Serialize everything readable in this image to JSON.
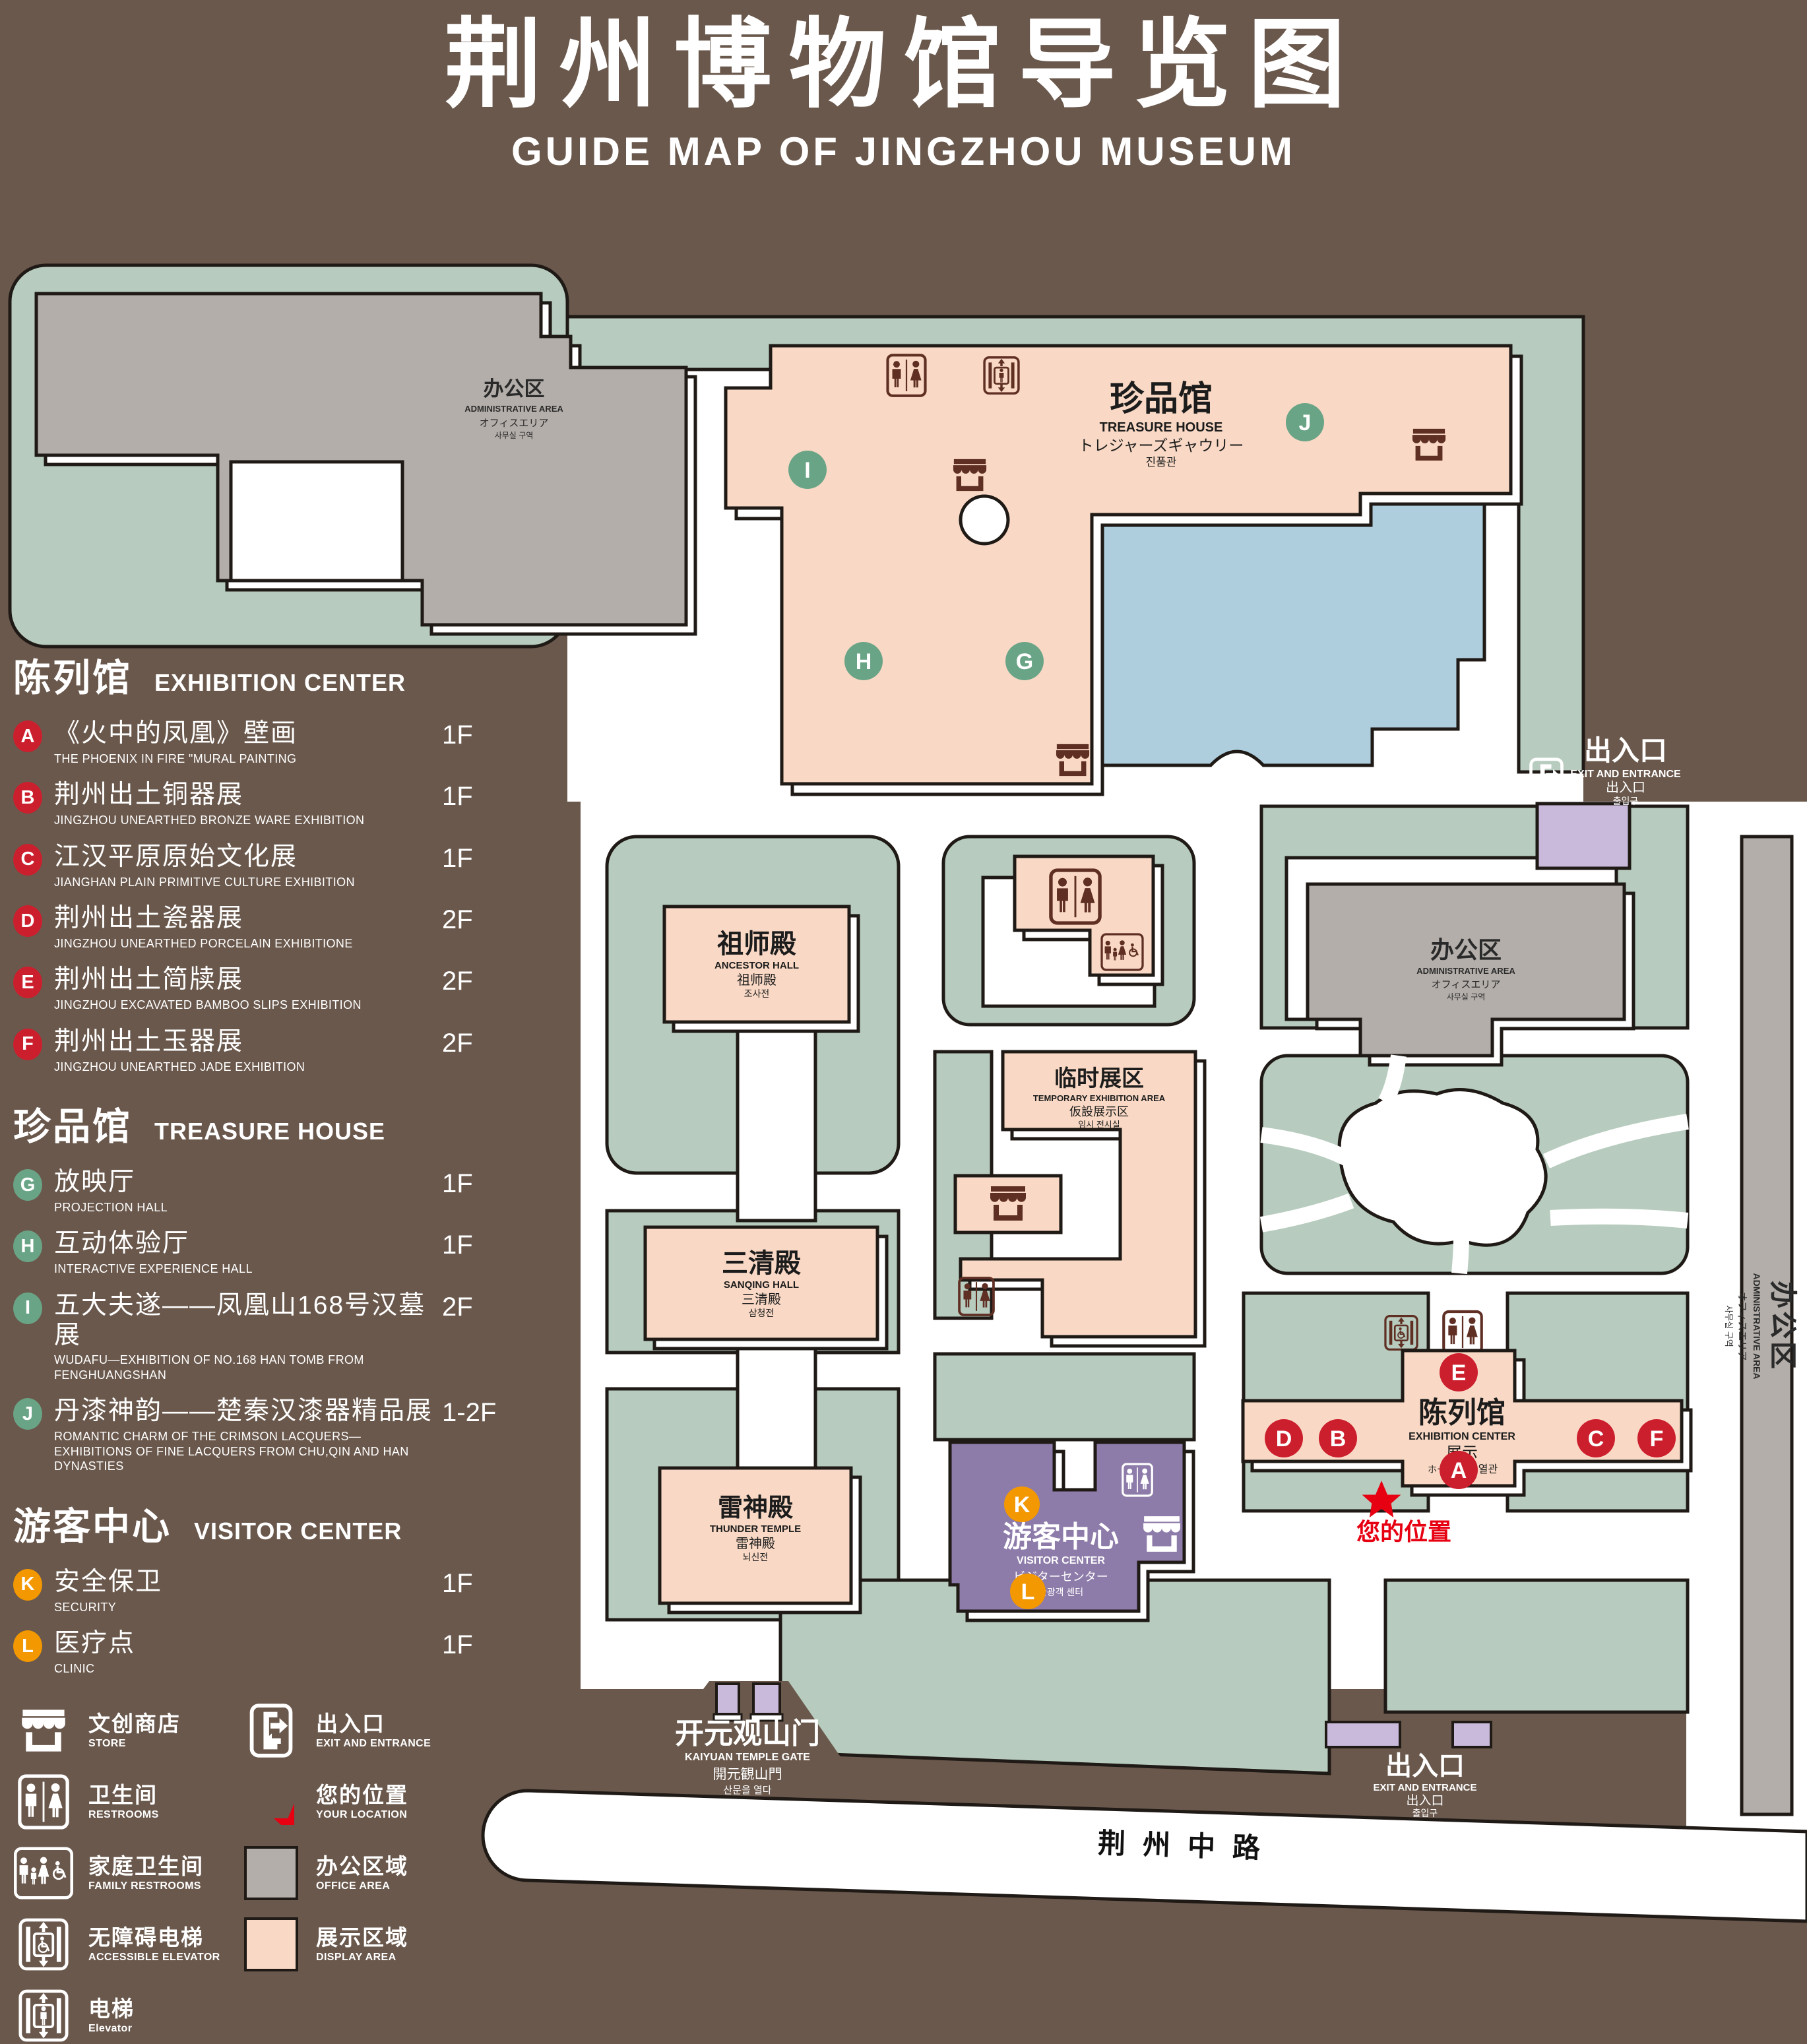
{
  "title": {
    "zh": "荆州博物馆导览图",
    "en": "GUIDE MAP OF JINGZHOU MUSEUM"
  },
  "legend": {
    "sections": [
      {
        "zh": "陈列馆",
        "en": "EXHIBITION CENTER",
        "items": [
          {
            "letter": "A",
            "zh": "《火中的凤凰》壁画",
            "en": "THE PHOENIX IN FIRE \"MURAL PAINTING",
            "floor": "1F"
          },
          {
            "letter": "B",
            "zh": "荆州出土铜器展",
            "en": "JINGZHOU UNEARTHED BRONZE WARE EXHIBITION",
            "floor": "1F"
          },
          {
            "letter": "C",
            "zh": "江汉平原原始文化展",
            "en": "JIANGHAN PLAIN PRIMITIVE CULTURE EXHIBITION",
            "floor": "1F"
          },
          {
            "letter": "D",
            "zh": "荆州出土瓷器展",
            "en": "JINGZHOU UNEARTHED PORCELAIN EXHIBITIONE",
            "floor": "2F"
          },
          {
            "letter": "E",
            "zh": "荆州出土简牍展",
            "en": "JINGZHOU EXCAVATED BAMBOO SLIPS EXHIBITION",
            "floor": "2F"
          },
          {
            "letter": "F",
            "zh": "荆州出土玉器展",
            "en": "JINGZHOU UNEARTHED JADE EXHIBITION",
            "floor": "2F"
          }
        ]
      },
      {
        "zh": "珍品馆",
        "en": "TREASURE HOUSE",
        "items": [
          {
            "letter": "G",
            "zh": "放映厅",
            "en": "PROJECTION HALL",
            "floor": "1F"
          },
          {
            "letter": "H",
            "zh": "互动体验厅",
            "en": "INTERACTIVE EXPERIENCE HALL",
            "floor": "1F"
          },
          {
            "letter": "I",
            "zh": "五大夫遂——凤凰山168号汉墓展",
            "en": "WUDAFU—EXHIBITION OF NO.168 HAN TOMB FROM FENGHUANGSHAN",
            "floor": "2F"
          },
          {
            "letter": "J",
            "zh": "丹漆神韵——楚秦汉漆器精品展",
            "en": "ROMANTIC CHARM OF THE CRIMSON LACQUERS—EXHIBITIONS OF FINE LACQUERS FROM CHU,QIN AND HAN DYNASTIES",
            "floor": "1-2F"
          }
        ]
      },
      {
        "zh": "游客中心",
        "en": "VISITOR CENTER",
        "items": [
          {
            "letter": "K",
            "zh": "安全保卫",
            "en": "SECURITY",
            "floor": "1F"
          },
          {
            "letter": "L",
            "zh": "医疗点",
            "en": "CLINIC",
            "floor": "1F"
          }
        ]
      }
    ],
    "icon_items_left": [
      {
        "icon": "store-icon",
        "zh": "文创商店",
        "en": "STORE"
      },
      {
        "icon": "restroom-icon",
        "zh": "卫生间",
        "en": "RESTROOMS"
      },
      {
        "icon": "family-restroom-icon",
        "zh": "家庭卫生间",
        "en": "FAMILY RESTROOMS"
      },
      {
        "icon": "accessible-elevator-icon",
        "zh": "无障碍电梯",
        "en": "ACCESSIBLE ELEVATOR"
      },
      {
        "icon": "elevator-icon",
        "zh": "电梯",
        "en": "Elevator"
      }
    ],
    "icon_items_right": [
      {
        "icon": "exit-icon",
        "zh": "出入口",
        "en": "EXIT AND ENTRANCE"
      },
      {
        "icon": "location-star-icon",
        "zh": "您的位置",
        "en": "YOUR LOCATION"
      },
      {
        "icon": "office-area-swatch",
        "zh": "办公区域",
        "en": "OFFICE AREA"
      },
      {
        "icon": "display-area-swatch",
        "zh": "展示区域",
        "en": "DISPLAY AREA"
      }
    ]
  },
  "map": {
    "labels": {
      "admin_top": {
        "zh": "办公区",
        "en": "ADMINISTRATIVE AREA",
        "ja": "オフィスエリア",
        "ko": "사무실 구역"
      },
      "admin_right": {
        "zh": "办公区",
        "en": "ADMINISTRATIVE AREA",
        "ja": "オフィスエリア",
        "ko": "사무실 구역"
      },
      "admin_side": {
        "zh": "办公区",
        "en": "ADMINISTRATIVE AREA",
        "ja": "オフィスエリア",
        "ko": "사무실 구역"
      },
      "treasure_house": {
        "zh": "珍品馆",
        "en": "TREASURE HOUSE",
        "ja": "トレジャーズギャウリー",
        "ko": "진품관"
      },
      "ancestor_hall": {
        "zh": "祖师殿",
        "en": "ANCESTOR HALL",
        "ja": "祖师殿",
        "ko": "조사전"
      },
      "sanqing_hall": {
        "zh": "三清殿",
        "en": "SANQING HALL",
        "ja": "三清殿",
        "ko": "삼청전"
      },
      "temporary_area": {
        "zh": "临时展区",
        "en": "TEMPORARY EXHIBITION AREA",
        "ja": "仮設展示区",
        "ko": "임시 전시실"
      },
      "thunder_temple": {
        "zh": "雷神殿",
        "en": "THUNDER TEMPLE",
        "ja": "雷神殿",
        "ko": "뇌신전"
      },
      "visitor_center": {
        "zh": "游客中心",
        "en": "VISITOR CENTER",
        "ja": "ビジターセンター",
        "ko": "관광객 센터"
      },
      "exhibition_center": {
        "zh": "陈列馆",
        "en": "EXHIBITION CENTER",
        "zh2": "展示",
        "ja": "ホール",
        "ko": "진열관"
      },
      "kaiyuan_gate": {
        "zh": "开元观山门",
        "en": "KAIYUAN TEMPLE GATE",
        "ja": "開元観山門",
        "ko": "산문을 열다"
      },
      "exit_top": {
        "zh": "出入口",
        "en": "EXIT AND ENTRANCE",
        "ja": "出入口",
        "ko": "출입구"
      },
      "exit_bottom": {
        "zh": "出入口",
        "en": "EXIT AND ENTRANCE",
        "ja": "出入口",
        "ko": "출입구"
      },
      "road": "荆州中路",
      "your_location": "您的位置"
    },
    "markers": [
      {
        "letter": "I",
        "type": "green"
      },
      {
        "letter": "J",
        "type": "green"
      },
      {
        "letter": "H",
        "type": "green"
      },
      {
        "letter": "G",
        "type": "green"
      },
      {
        "letter": "E",
        "type": "red"
      },
      {
        "letter": "D",
        "type": "red"
      },
      {
        "letter": "B",
        "type": "red"
      },
      {
        "letter": "C",
        "type": "red"
      },
      {
        "letter": "F",
        "type": "red"
      },
      {
        "letter": "A",
        "type": "red"
      },
      {
        "letter": "K",
        "type": "orange"
      },
      {
        "letter": "L",
        "type": "orange"
      }
    ]
  },
  "colors": {
    "background": "#6a584c",
    "green_area": "#b7ccbe",
    "display_area": "#f9d9c5",
    "office_area": "#b3aeaa",
    "pond": "#afcedd",
    "visitor_center": "#8d7ba9",
    "gate_purple": "#c9b9da",
    "red_marker": "#cc1f2e",
    "green_marker": "#6aa486",
    "orange_marker": "#f39800",
    "icon_brown": "#5f2f24",
    "location_red": "#e60012"
  }
}
